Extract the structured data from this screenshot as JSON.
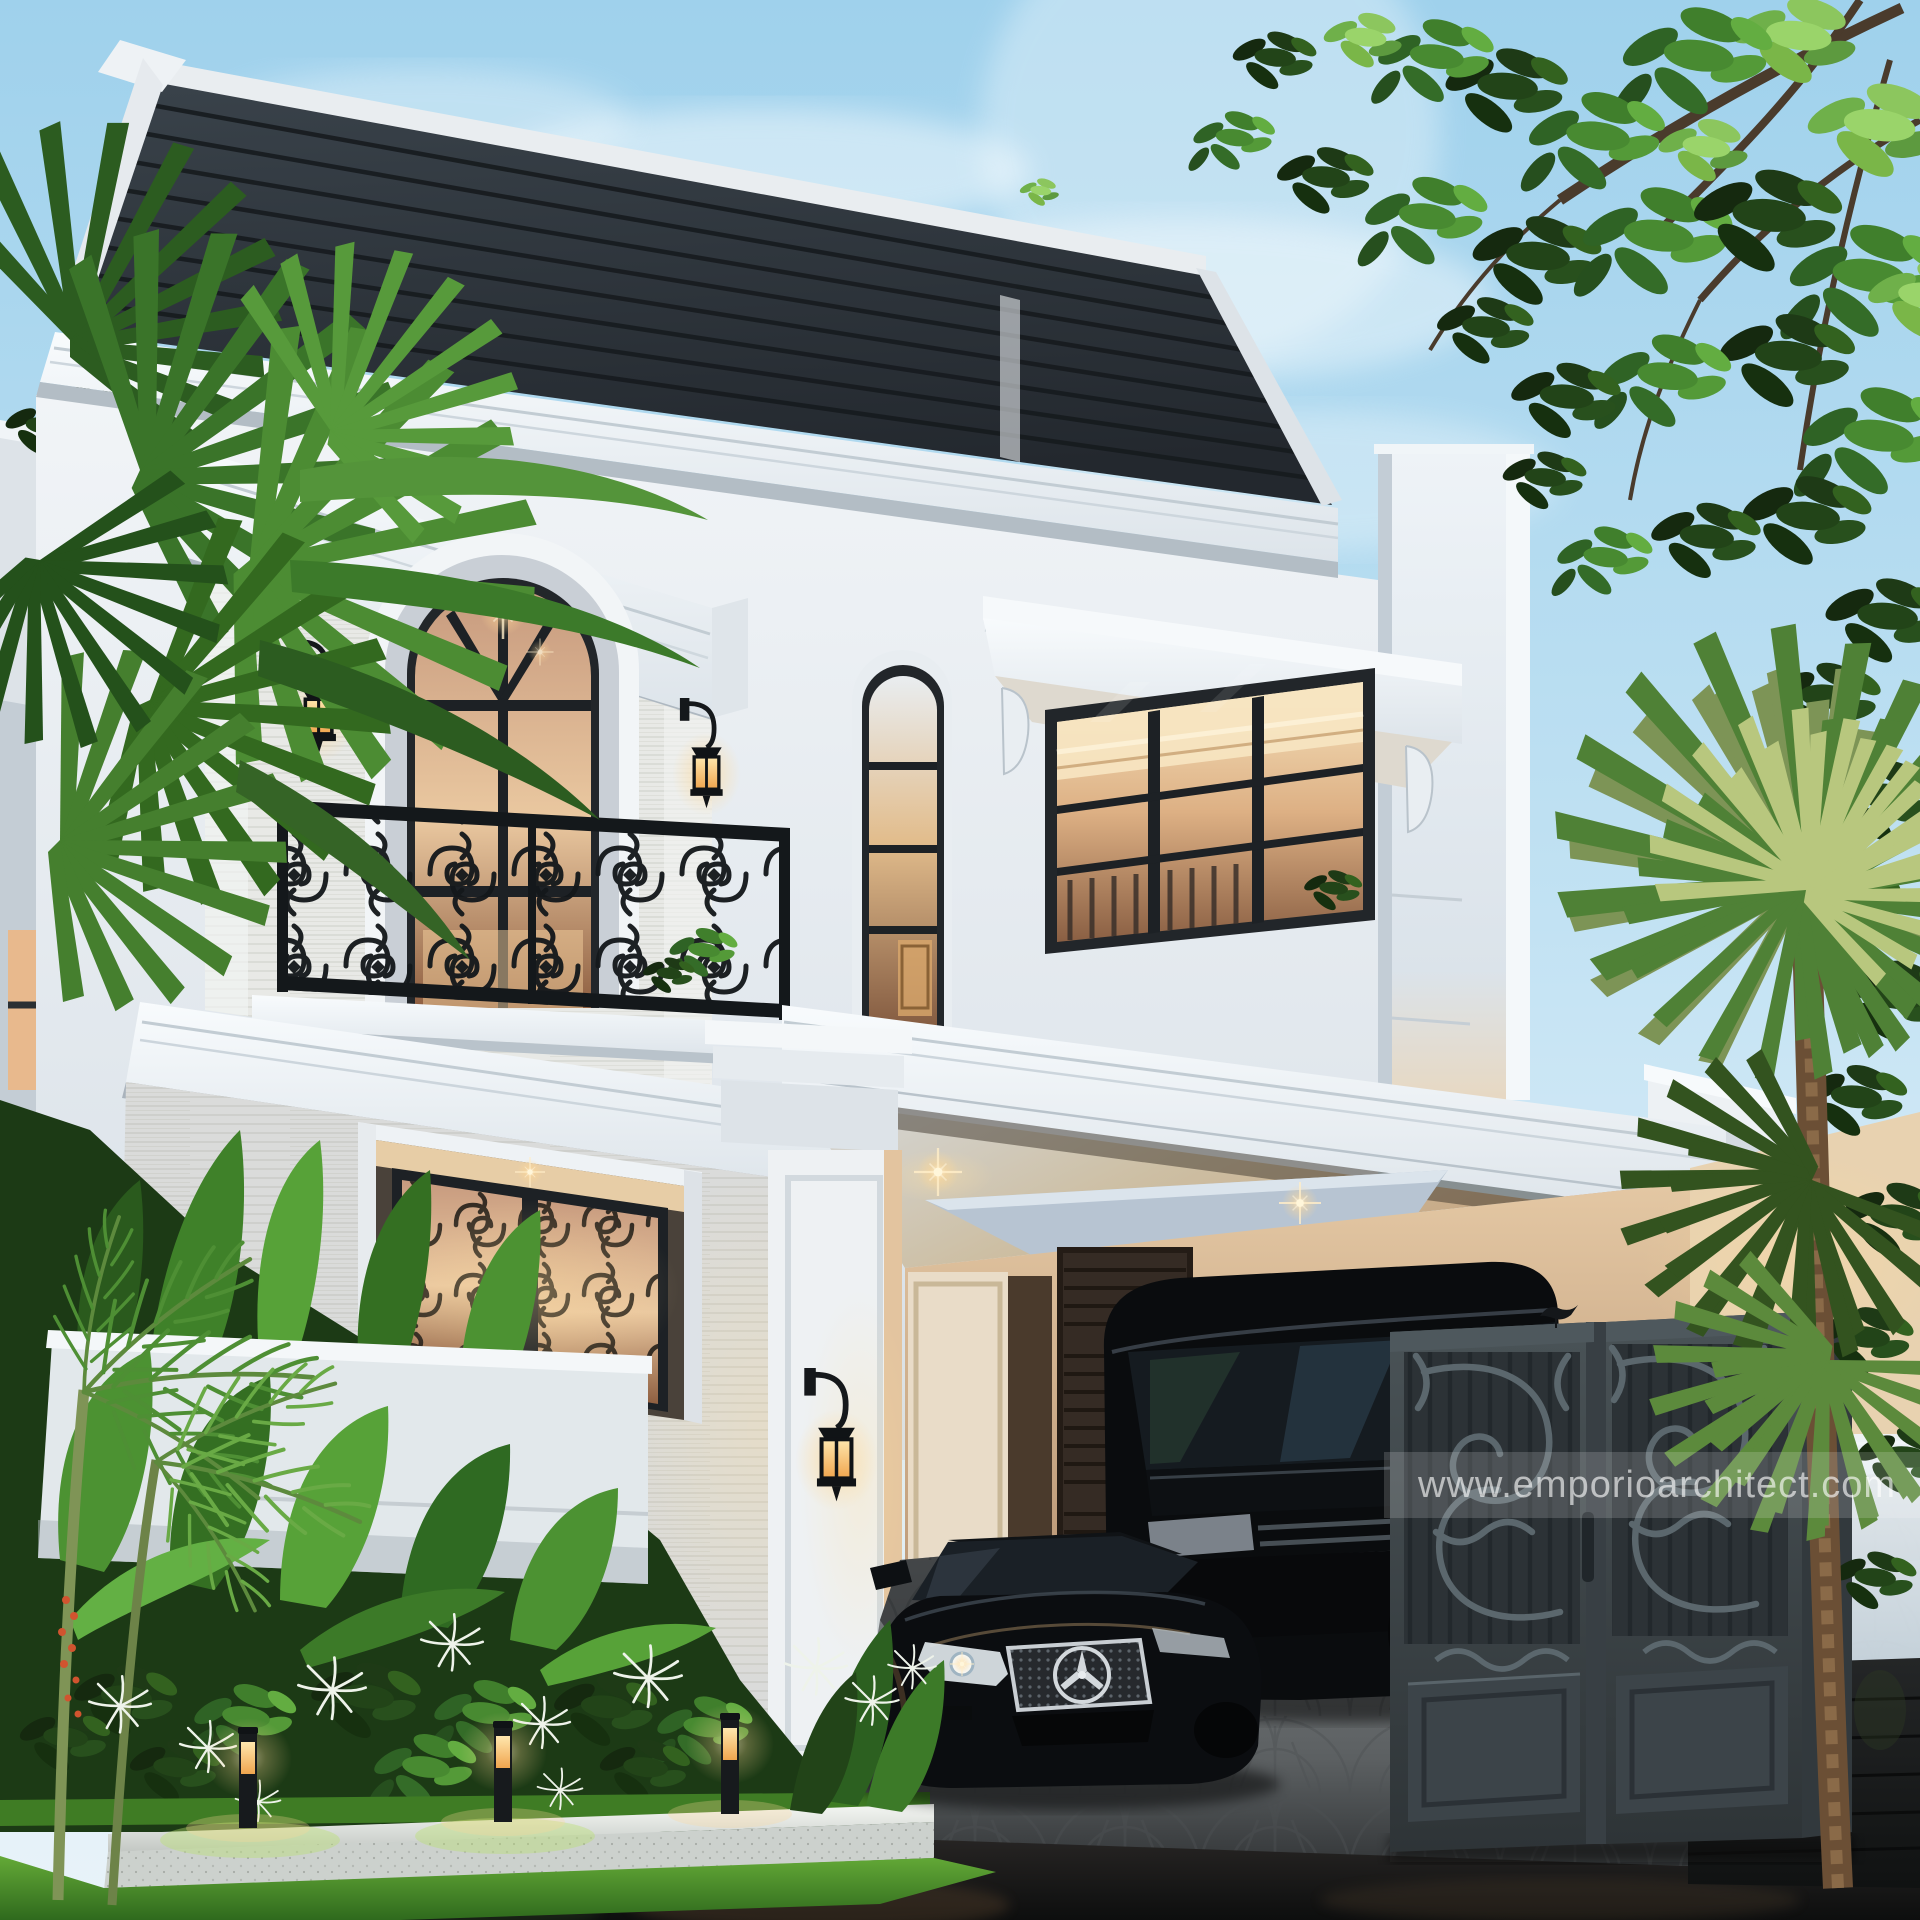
{
  "watermark": {
    "text": "www.emporioarchitect.com"
  },
  "palette": {
    "sky_top": "#9fd1ec",
    "sky_mid": "#c2e2f3",
    "sky_low": "#e8f3f9",
    "roof_dark": "#272d33",
    "roof_seam": "#171b1f",
    "trim_white": "#f4f7f9",
    "cornice_shadow": "#b3bdc5",
    "wall_light": "#eef1f4",
    "wall_shadow": "#c9d2da",
    "travertine": "#e8e9e6",
    "frame_dark": "#22262a",
    "iron_dark": "#14181b",
    "glass_warm_hi": "#eac8a0",
    "glass_warm_lo": "#8f5f41",
    "ceiling_cool": "#d3d6d8",
    "ceiling_warm": "#c49f78",
    "backwall_warm": "#b98c64",
    "gate_frame": "#434c51",
    "gate_panel": "#343b3f",
    "gate_scroll": "#5b676d",
    "frost_panel": "#e3ebf0",
    "stone_dark": "#1d1f20",
    "cobble_light": "#85898b",
    "cobble_joint": "#4c5052",
    "asphalt": "#141516",
    "grass_bright": "#5fa535",
    "leaf_dark": "#1c3a15",
    "leaf_mid": "#3c7a28",
    "leaf_bright": "#63b044",
    "tree_dark": "#24421f",
    "tree_bright": "#7ab648",
    "palm_olive": "#7d9456",
    "trunk_brown": "#6b4f35",
    "car_black": "#0b0d10",
    "chrome": "#c9ced3",
    "glow_warm": "#ffd896",
    "curb_white": "#f1f3f0"
  }
}
